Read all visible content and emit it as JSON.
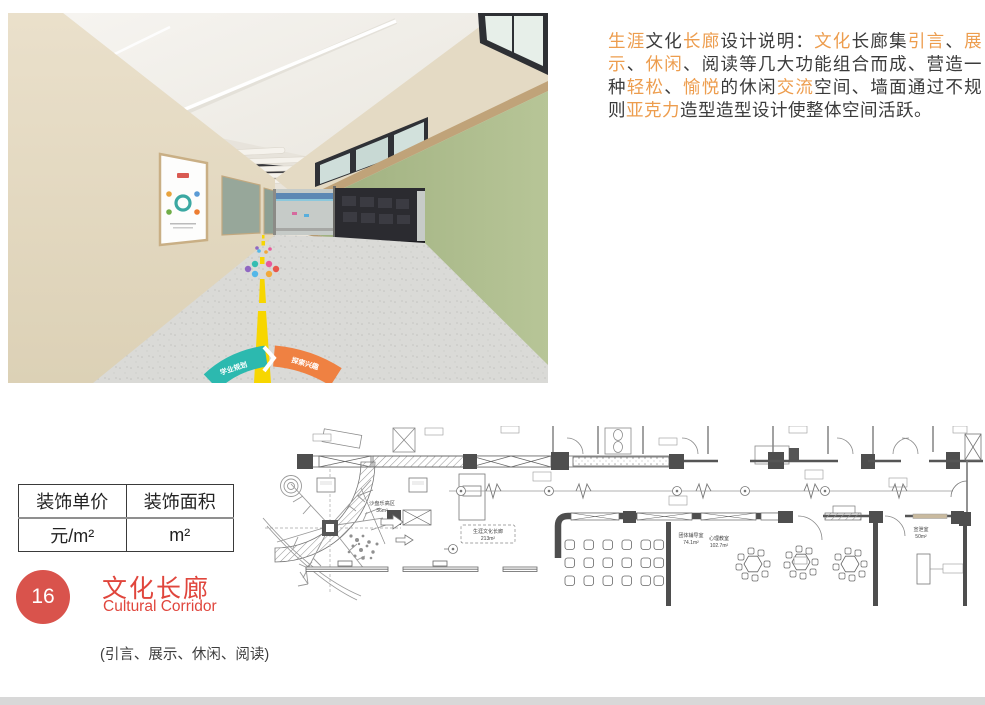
{
  "description": {
    "colors": {
      "highlight": "#ED9D4E",
      "normal": "#3B3B3B"
    },
    "segments": [
      {
        "t": "生涯",
        "h": true
      },
      {
        "t": "文化",
        "h": false
      },
      {
        "t": "长廊",
        "h": true
      },
      {
        "t": "设计说明：",
        "h": false
      },
      {
        "t": "文化",
        "h": true
      },
      {
        "t": "长廊集",
        "h": false
      },
      {
        "t": "引言",
        "h": true
      },
      {
        "t": "、",
        "h": false
      },
      {
        "t": "展示",
        "h": true
      },
      {
        "t": "、",
        "h": false
      },
      {
        "t": "休闲",
        "h": true
      },
      {
        "t": "、阅读等几大功能组合而成、营造一种",
        "h": false
      },
      {
        "t": "轻松",
        "h": true
      },
      {
        "t": "、",
        "h": false
      },
      {
        "t": "愉悦",
        "h": true
      },
      {
        "t": "的休闲",
        "h": false
      },
      {
        "t": "交流",
        "h": true
      },
      {
        "t": "空间、墙面通过不规则",
        "h": false
      },
      {
        "t": "亚克力",
        "h": true
      },
      {
        "t": "造型造型设计使整体空间活跃。",
        "h": false
      }
    ]
  },
  "table": {
    "headers": [
      "装饰单价",
      "装饰面积"
    ],
    "values": [
      "元/m²",
      "m²"
    ]
  },
  "section": {
    "number": "16",
    "title": "文化长廊",
    "subtitle": "Cultural Corridor",
    "note": "(引言、展示、休闲、阅读)",
    "badge_color": "#D9534C",
    "title_color": "#E0463D"
  },
  "photo": {
    "floor_decal_left": "学业规划",
    "floor_decal_right": "探索兴趣",
    "colors": {
      "wall_green": "#AEBD8D",
      "wall_beige": "#E5DBC5",
      "wood_trim": "#C0A379",
      "floor": "#DADAD7",
      "line_yellow": "#F7D600",
      "decal_teal": "#2CB9AF",
      "decal_orange": "#EF8142"
    }
  },
  "floor_plan": {
    "rooms": [
      {
        "name": "沙盘乐高区",
        "area": "36m²"
      },
      {
        "name": "生涯文化长廊",
        "area": "213m²"
      },
      {
        "name": "团体辅导室",
        "area": "74.1m²"
      },
      {
        "name": "心理教室",
        "area": "102.7m²"
      },
      {
        "name": "宣泄室",
        "area": "50m²"
      }
    ]
  }
}
